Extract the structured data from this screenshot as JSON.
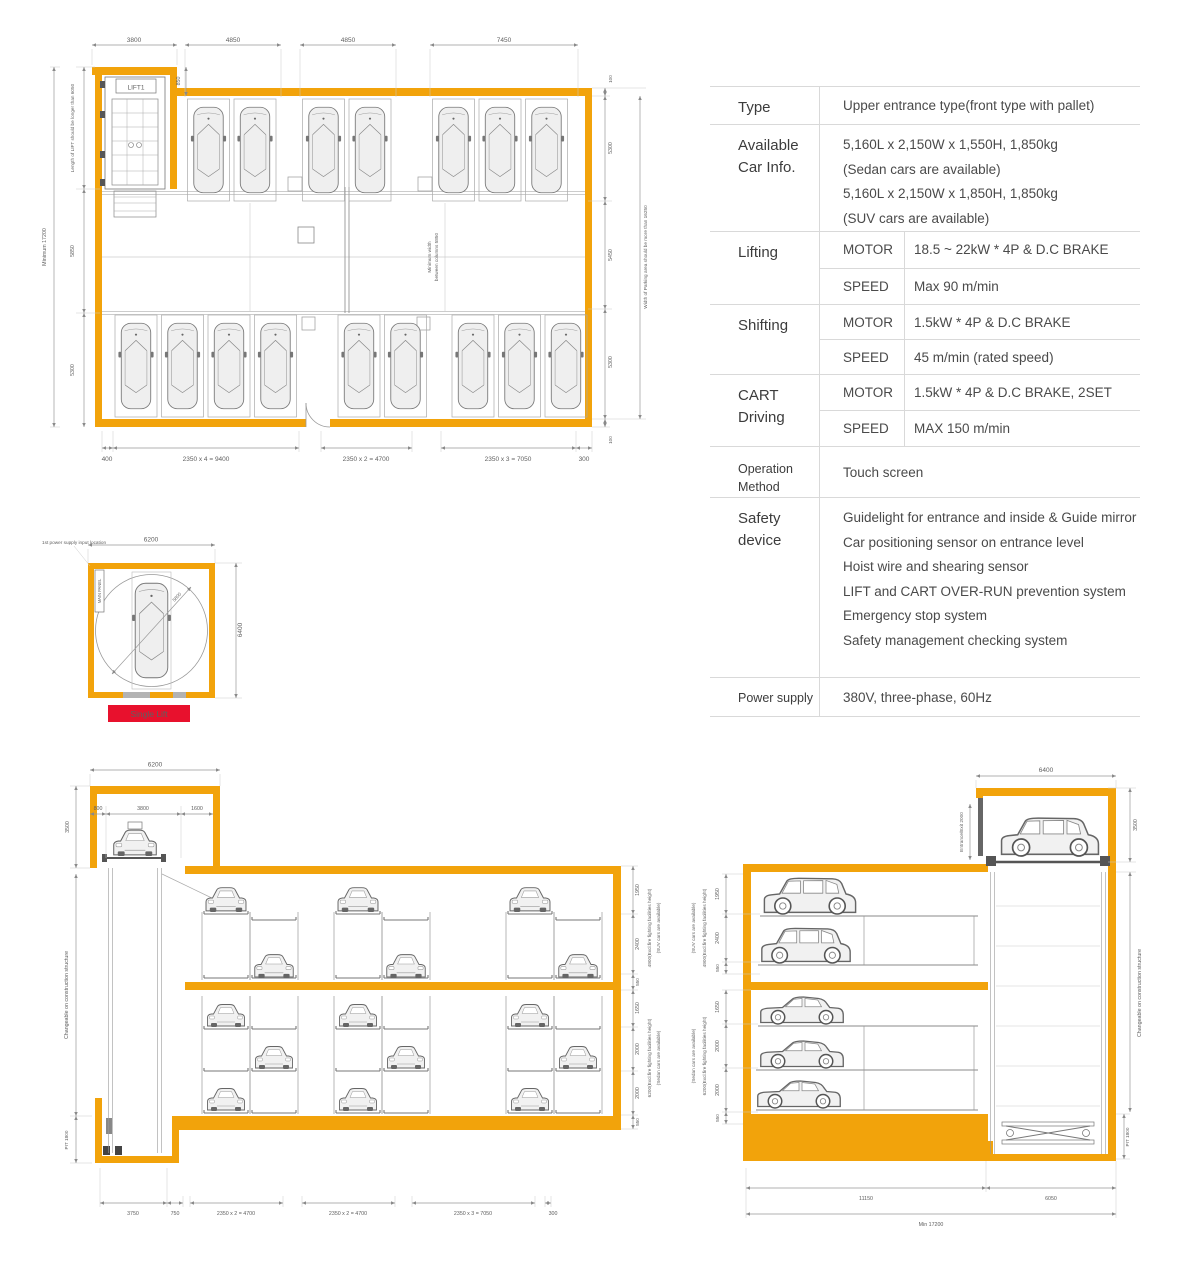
{
  "colors": {
    "wall": "#F2A30B",
    "banner": "#E8112D"
  },
  "floor_plan": {
    "top_dims": [
      "3800",
      "4850",
      "4850",
      "7450"
    ],
    "step_dim": "850",
    "lift_label": "LIFT1",
    "left_outer": "Minimum 17200",
    "left_chain": [
      "Length of LIFT should be longer than 6050",
      "5850",
      "5300"
    ],
    "right_outer": "Width of Parking area should be more than 16250",
    "right_chain": [
      "100",
      "5300",
      "5450",
      "5300",
      "100"
    ],
    "aisle_note": [
      "Minimum width",
      "between columns 5850"
    ],
    "bottom_dims": [
      "400",
      "2350 x 4 = 9400",
      "2350 x 2 = 4700",
      "2350 x 3 = 7050",
      "300"
    ]
  },
  "spec_table": {
    "rows": [
      {
        "label": "Type",
        "value": "Upper entrance type(front type with pallet)"
      },
      {
        "label": "Available Car Info.",
        "lines": [
          "5,160L x 2,150W x 1,550H, 1,850kg",
          "(Sedan cars are available)",
          "5,160L x 2,150W x 1,850H, 1,850kg",
          "(SUV cars are available)"
        ]
      },
      {
        "label": "Lifting",
        "sub": [
          {
            "key": "MOTOR",
            "value": "18.5 ~ 22kW * 4P & D.C BRAKE"
          },
          {
            "key": "SPEED",
            "value": "Max 90 m/min"
          }
        ]
      },
      {
        "label": "Shifting",
        "sub": [
          {
            "key": "MOTOR",
            "value": "1.5kW * 4P & D.C BRAKE"
          },
          {
            "key": "SPEED",
            "value": "45 m/min (rated speed)"
          }
        ]
      },
      {
        "label": "CART Driving",
        "sub": [
          {
            "key": "MOTOR",
            "value": "1.5kW * 4P & D.C BRAKE, 2SET"
          },
          {
            "key": "SPEED",
            "value": "MAX 150 m/min"
          }
        ]
      },
      {
        "label": "Operation Method",
        "value": "Touch screen"
      },
      {
        "label": "Safety device",
        "lines": [
          "Guidelight for entrance and inside & Guide mirror",
          "Car positioning sensor on entrance level",
          "Hoist wire and shearing sensor",
          "LIFT and CART OVER-RUN prevention system",
          "Emergency stop system",
          "Safety management checking system"
        ]
      },
      {
        "label": "Power supply",
        "value": "380V, three-phase, 60Hz"
      }
    ]
  },
  "single_lift": {
    "top_dim": "6200",
    "right_dim": "6400",
    "turn_dim": "5800",
    "panel_label": "MAIN PANEL",
    "power_note": "1st power supply input location",
    "banner": "Single Lift"
  },
  "left_elevation": {
    "top_dim": "6200",
    "inner_dims": [
      "800",
      "3800",
      "1600"
    ],
    "height_dim": "3500",
    "side_note": "Changeable on construction structure",
    "pit_dim": "PIT 1800",
    "upper_chain": [
      "1950",
      "2400",
      "550"
    ],
    "upper_notes": [
      "4900(Excl.fire fighting facilities height)",
      "(SUV cars are available)"
    ],
    "lower_chain": [
      "1650",
      "2000",
      "2000",
      "550"
    ],
    "lower_notes": [
      "6200(Excl.fire fighting facilities height)",
      "(Sedan cars are available)"
    ],
    "bottom_dims": [
      "3750",
      "750",
      "2350 x 2 = 4700",
      "2350 x 2 = 4700",
      "2350 x 3 = 7050",
      "300"
    ]
  },
  "right_elevation": {
    "top_dim": "6400",
    "entrance_note": "Entrance/Exit 2000",
    "height_dim": "3500",
    "side_note": "Changeable on construction structure",
    "pit_dim": "PIT 1800",
    "upper_chain": [
      "1950",
      "2400",
      "550"
    ],
    "upper_notes": [
      "4900(Excl.fire fighting facilities height)",
      "(SUV cars are available)"
    ],
    "lower_chain": [
      "1650",
      "2000",
      "2000",
      "550"
    ],
    "lower_notes": [
      "6200(Excl.fire fighting facilities height)",
      "(Sedan cars are available)"
    ],
    "bottom_dims": [
      "11150",
      "6050",
      "Min 17200"
    ]
  }
}
